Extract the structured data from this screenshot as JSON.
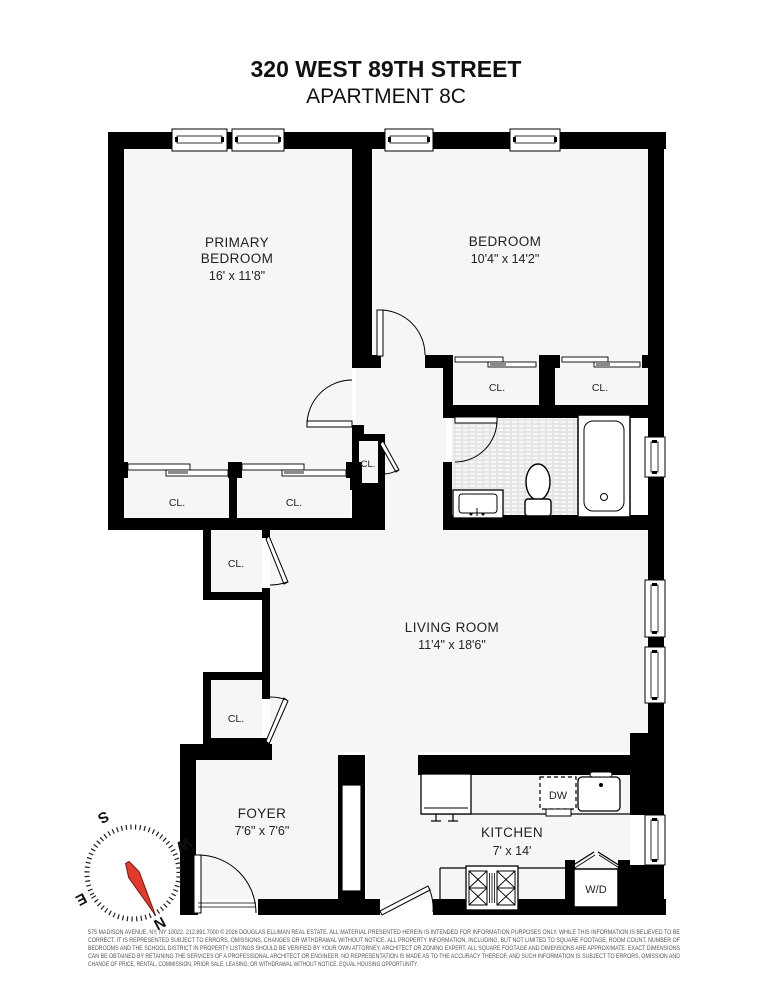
{
  "title": {
    "line1": "320 WEST 89TH STREET",
    "line2": "APARTMENT 8C"
  },
  "rooms": {
    "primary_bedroom": {
      "name_line1": "PRIMARY",
      "name_line2": "BEDROOM",
      "dims": "16' x 11'8\""
    },
    "bedroom": {
      "name": "BEDROOM",
      "dims": "10'4\" x 14'2\""
    },
    "living_room": {
      "name": "LIVING ROOM",
      "dims": "11'4\" x 18'6\""
    },
    "foyer": {
      "name": "FOYER",
      "dims": "7'6\" x 7'6\""
    },
    "kitchen": {
      "name": "KITCHEN",
      "dims": "7' x 14'"
    }
  },
  "closets": {
    "label": "CL."
  },
  "appliances": {
    "dishwasher": "DW",
    "washer_dryer": "W/D"
  },
  "compass": {
    "n": "N",
    "s": "S",
    "e": "E",
    "w": "W",
    "needle_color": "#e23b2e"
  },
  "colors": {
    "wall": "#000000",
    "floor": "#f6f6f6",
    "accent_red": "#e23b2e"
  },
  "disclaimer": {
    "line1": "575 MADISON AVENUE, NY, NY 10022. 212.891.7000 © 2026 DOUGLAS ELLIMAN REAL ESTATE. ALL MATERIAL PRESENTED HEREIN IS INTENDED FOR INFORMATION PURPOSES ONLY. WHILE THIS INFORMATION IS BELIEVED TO BE",
    "line2": "CORRECT, IT IS REPRESENTED SUBJECT TO ERRORS, OMISSIONS, CHANGES OR WITHDRAWAL WITHOUT NOTICE. ALL PROPERTY INFORMATION, INCLUDING, BUT NOT LIMITED TO SQUARE FOOTAGE, ROOM COUNT, NUMBER OF",
    "line3": "BEDROOMS AND THE SCHOOL DISTRICT IN PROPERTY LISTINGS SHOULD BE VERIFIED BY YOUR OWN ATTORNEY, ARCHITECT OR ZONING EXPERT. ALL SQUARE FOOTAGE AND DIMENSIONS ARE APPROXIMATE. EXACT DIMENSIONS",
    "line4": "CAN BE OBTAINED BY RETAINING THE SERVICES OF A PROFESSIONAL ARCHITECT OR ENGINEER. NO REPRESENTATION IS MADE AS TO THE ACCURACY THEREOF, AND SUCH INFORMATION IS SUBJECT TO ERRORS, OMISSION AND",
    "line5": "CHANGE OF PRICE, RENTAL, COMMISSION, PRIOR SALE, LEASING, OR WITHDRAWAL WITHOUT NOTICE. EQUAL HOUSING OPPORTUNITY."
  }
}
